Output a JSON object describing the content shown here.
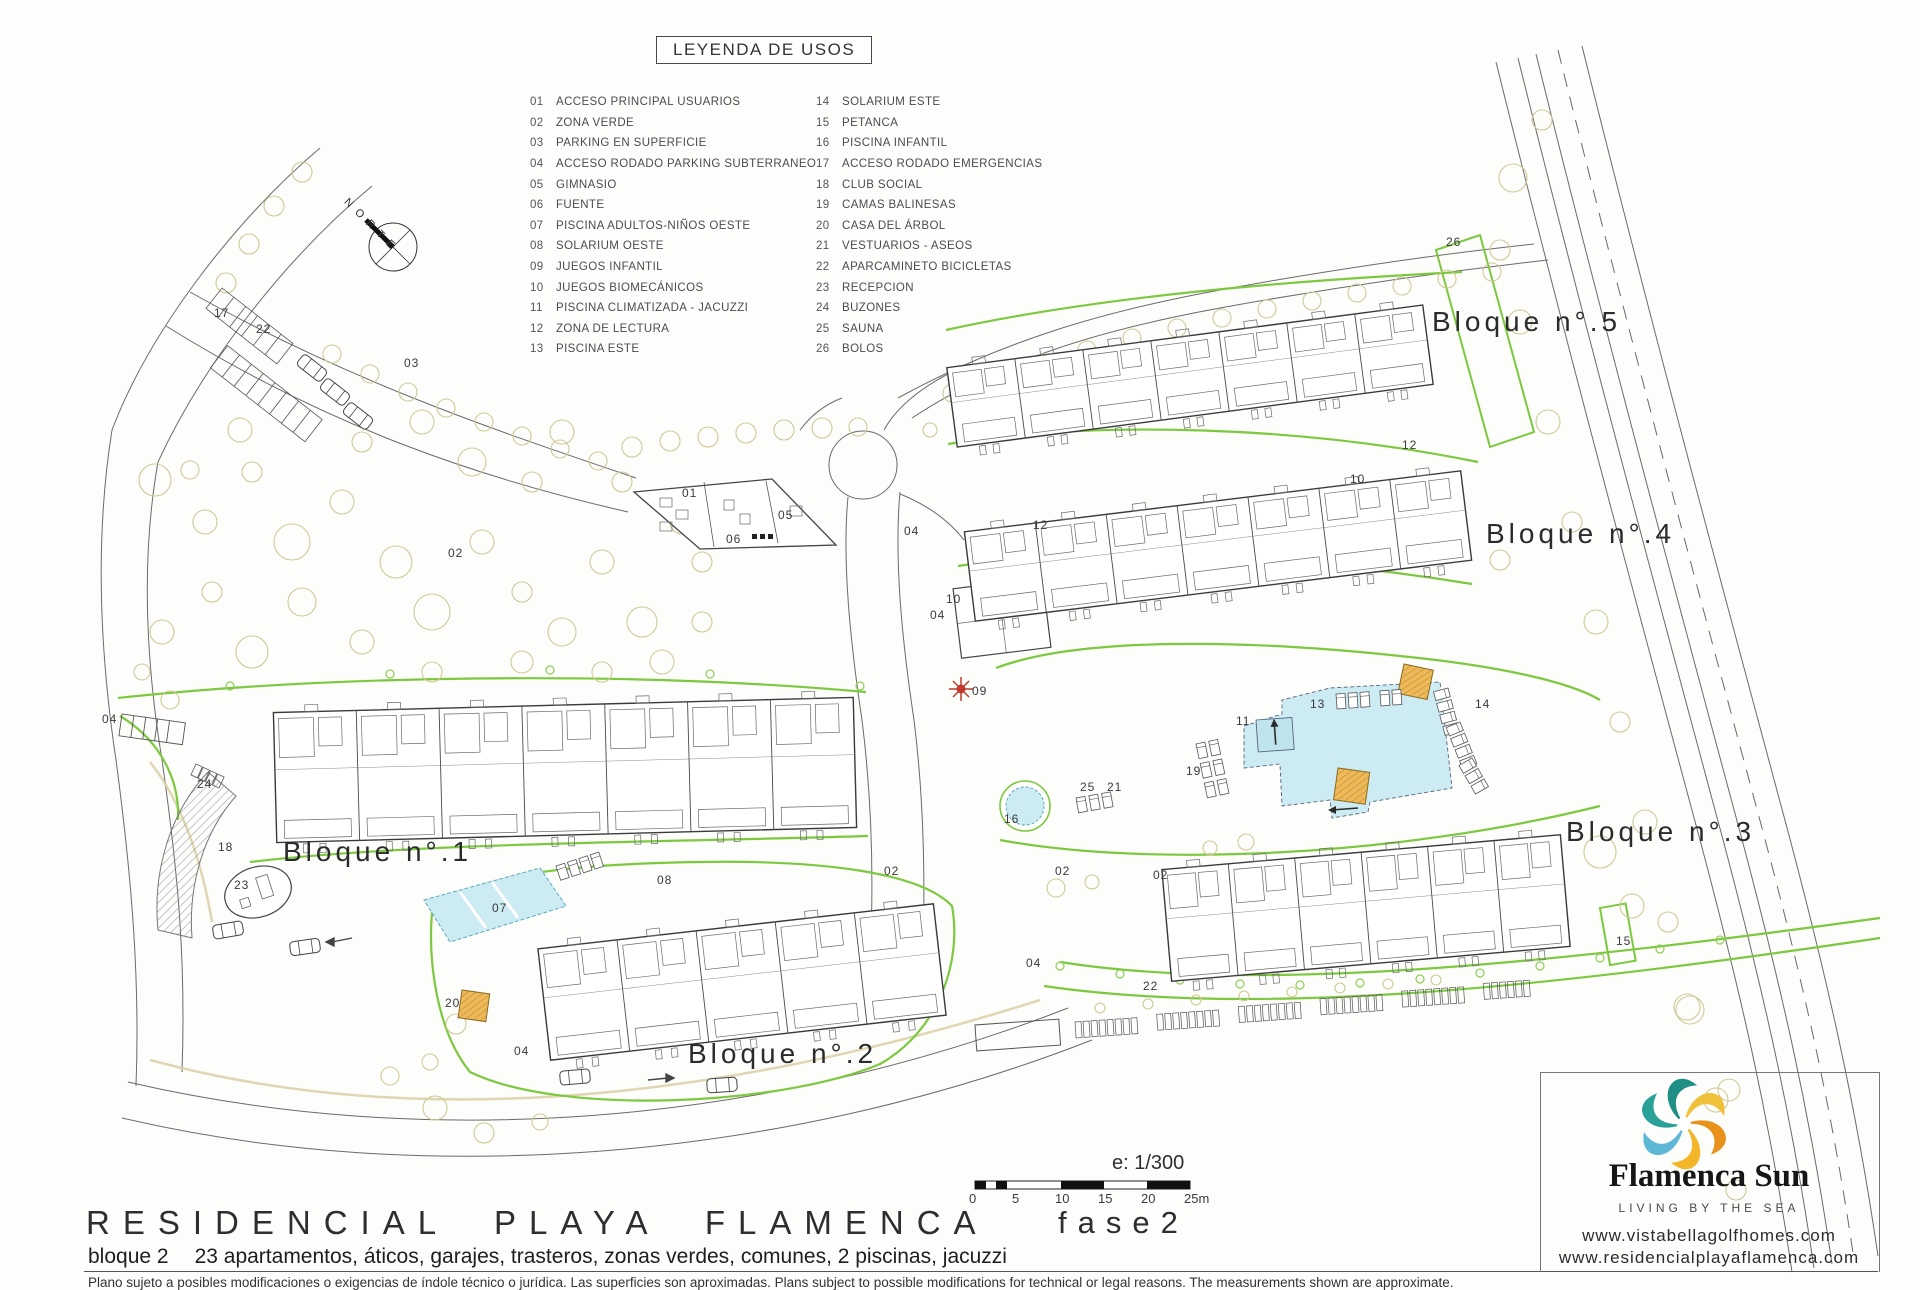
{
  "legend": {
    "title": "LEYENDA DE USOS",
    "items": [
      {
        "n": "01",
        "label": "ACCESO PRINCIPAL USUARIOS"
      },
      {
        "n": "02",
        "label": "ZONA VERDE"
      },
      {
        "n": "03",
        "label": "PARKING EN SUPERFICIE"
      },
      {
        "n": "04",
        "label": "ACCESO RODADO PARKING SUBTERRANEO"
      },
      {
        "n": "05",
        "label": "GIMNASIO"
      },
      {
        "n": "06",
        "label": "FUENTE"
      },
      {
        "n": "07",
        "label": "PISCINA ADULTOS-NIÑOS OESTE"
      },
      {
        "n": "08",
        "label": "SOLARIUM OESTE"
      },
      {
        "n": "09",
        "label": "JUEGOS INFANTIL"
      },
      {
        "n": "10",
        "label": "JUEGOS BIOMECÁNICOS"
      },
      {
        "n": "11",
        "label": "PISCINA CLIMATIZADA - JACUZZI"
      },
      {
        "n": "12",
        "label": "ZONA DE LECTURA"
      },
      {
        "n": "13",
        "label": "PISCINA ESTE"
      },
      {
        "n": "14",
        "label": "SOLARIUM ESTE"
      },
      {
        "n": "15",
        "label": "PETANCA"
      },
      {
        "n": "16",
        "label": "PISCINA INFANTIL"
      },
      {
        "n": "17",
        "label": "ACCESO RODADO EMERGENCIAS"
      },
      {
        "n": "18",
        "label": "CLUB SOCIAL"
      },
      {
        "n": "19",
        "label": "CAMAS BALINESAS"
      },
      {
        "n": "20",
        "label": "CASA DEL ÁRBOL"
      },
      {
        "n": "21",
        "label": "VESTUARIOS - ASEOS"
      },
      {
        "n": "22",
        "label": "APARCAMINETO BICICLETAS"
      },
      {
        "n": "23",
        "label": "RECEPCION"
      },
      {
        "n": "24",
        "label": "BUZONES"
      },
      {
        "n": "25",
        "label": "SAUNA"
      },
      {
        "n": "26",
        "label": "BOLOS"
      }
    ]
  },
  "plan": {
    "north_label": "NORTE",
    "block_labels": [
      {
        "label": "Bloque n°.1",
        "x": 283,
        "y": 836
      },
      {
        "label": "Bloque n°.2",
        "x": 688,
        "y": 1038
      },
      {
        "label": "Bloque n°.3",
        "x": 1566,
        "y": 816
      },
      {
        "label": "Bloque n°.4",
        "x": 1486,
        "y": 518
      },
      {
        "label": "Bloque n°.5",
        "x": 1432,
        "y": 306
      }
    ],
    "markers": [
      {
        "n": "17",
        "x": 214,
        "y": 306
      },
      {
        "n": "22",
        "x": 256,
        "y": 322
      },
      {
        "n": "03",
        "x": 404,
        "y": 356
      },
      {
        "n": "02",
        "x": 448,
        "y": 546
      },
      {
        "n": "01",
        "x": 682,
        "y": 486
      },
      {
        "n": "05",
        "x": 778,
        "y": 508
      },
      {
        "n": "06",
        "x": 726,
        "y": 532
      },
      {
        "n": "04",
        "x": 904,
        "y": 524
      },
      {
        "n": "04",
        "x": 930,
        "y": 608
      },
      {
        "n": "04",
        "x": 102,
        "y": 712
      },
      {
        "n": "04",
        "x": 1026,
        "y": 956
      },
      {
        "n": "04",
        "x": 514,
        "y": 1044
      },
      {
        "n": "12",
        "x": 1033,
        "y": 518
      },
      {
        "n": "12",
        "x": 1402,
        "y": 438
      },
      {
        "n": "10",
        "x": 1350,
        "y": 472
      },
      {
        "n": "10",
        "x": 946,
        "y": 592
      },
      {
        "n": "09",
        "x": 972,
        "y": 684
      },
      {
        "n": "16",
        "x": 1004,
        "y": 812
      },
      {
        "n": "25",
        "x": 1080,
        "y": 780
      },
      {
        "n": "21",
        "x": 1107,
        "y": 780
      },
      {
        "n": "19",
        "x": 1186,
        "y": 764
      },
      {
        "n": "11",
        "x": 1236,
        "y": 714
      },
      {
        "n": "13",
        "x": 1310,
        "y": 697
      },
      {
        "n": "14",
        "x": 1475,
        "y": 697
      },
      {
        "n": "02",
        "x": 884,
        "y": 864
      },
      {
        "n": "02",
        "x": 1055,
        "y": 864
      },
      {
        "n": "02",
        "x": 1153,
        "y": 868
      },
      {
        "n": "08",
        "x": 657,
        "y": 873
      },
      {
        "n": "07",
        "x": 492,
        "y": 901
      },
      {
        "n": "20",
        "x": 445,
        "y": 996
      },
      {
        "n": "18",
        "x": 218,
        "y": 840
      },
      {
        "n": "23",
        "x": 234,
        "y": 878
      },
      {
        "n": "24",
        "x": 197,
        "y": 777
      },
      {
        "n": "22",
        "x": 1143,
        "y": 979
      },
      {
        "n": "15",
        "x": 1616,
        "y": 934
      },
      {
        "n": "26",
        "x": 1446,
        "y": 235
      }
    ]
  },
  "scale": {
    "ratio": "e: 1/300",
    "ticks": [
      "0",
      "5",
      "10",
      "15",
      "20",
      "25m"
    ]
  },
  "title_block": {
    "title": "RESIDENCIAL PLAYA FLAMENCA",
    "phase": "fase2",
    "subtitle_prefix": "bloque 2",
    "subtitle_rest": "23 apartamentos, áticos, garajes, trasteros, zonas verdes, comunes, 2 piscinas, jacuzzi",
    "disclaimer": "Plano sujeto a posibles modificaciones o exigencias de índole técnico o jurídica. Las superficies son aproximadas. Plans subject to possible modifications for technical or legal reasons. The measurements shown are approximate."
  },
  "brand": {
    "name": "Flamenca Sun",
    "tagline": "LIVING BY THE SEA",
    "urls": [
      "www.vistabellagolfhomes.com",
      "www.residencialplayaflamenca.com"
    ],
    "colors": {
      "green_line": "#7cc83e",
      "pool_fill": "#cdebf2",
      "tree_stroke": "#cfc996",
      "orange_kiosk": "#e9b455",
      "logo_palette": [
        "#f0c23c",
        "#e8921c",
        "#f3b52a",
        "#5fb7d6",
        "#2aa198",
        "#1f8f86"
      ]
    }
  }
}
